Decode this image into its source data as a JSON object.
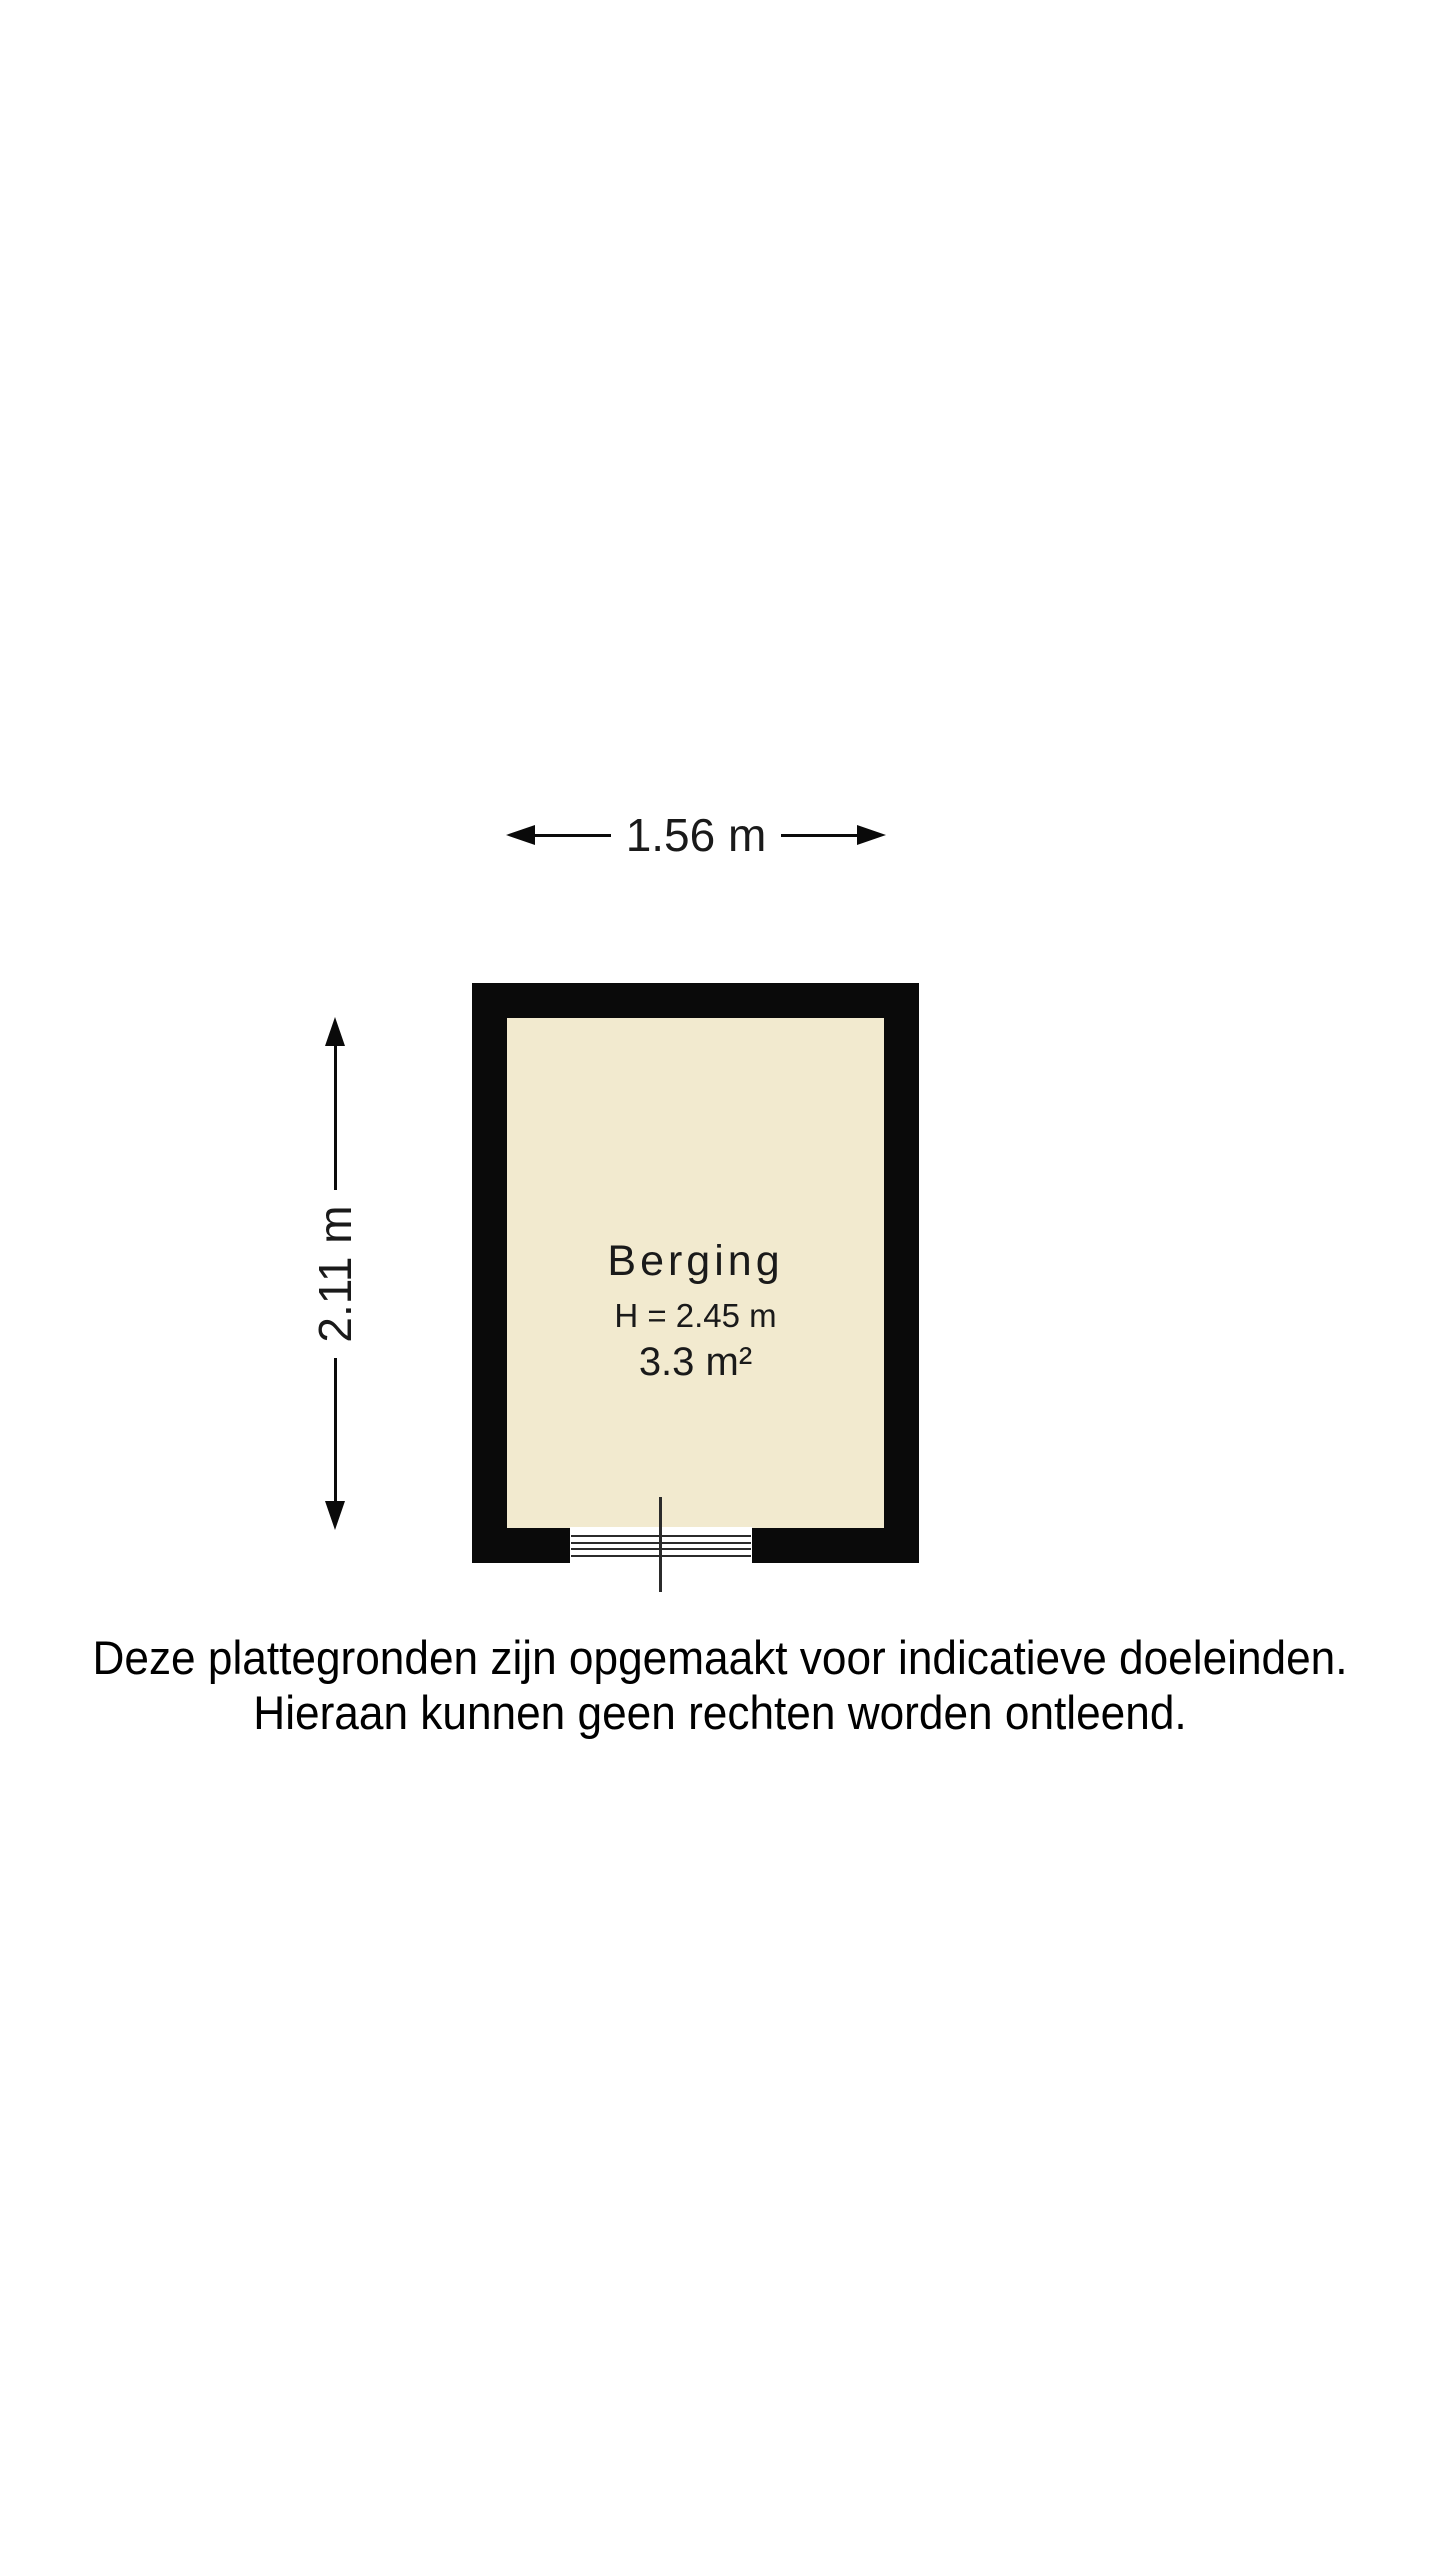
{
  "floorplan": {
    "dimensions": {
      "width_label": "1.56 m",
      "height_label": "2.11 m"
    },
    "room": {
      "name": "Berging",
      "ceiling_height_label": "H = 2.45 m",
      "area_label": "3.3 m²"
    },
    "colors": {
      "wall": "#0a0a0a",
      "room_fill": "#F2EACF",
      "line": "#2b2b2b",
      "text": "#1a1a1a",
      "background": "#ffffff"
    }
  },
  "disclaimer": {
    "line1": "Deze plattegronden zijn opgemaakt voor indicatieve doeleinden.",
    "line2": "Hieraan kunnen geen rechten worden ontleend."
  }
}
